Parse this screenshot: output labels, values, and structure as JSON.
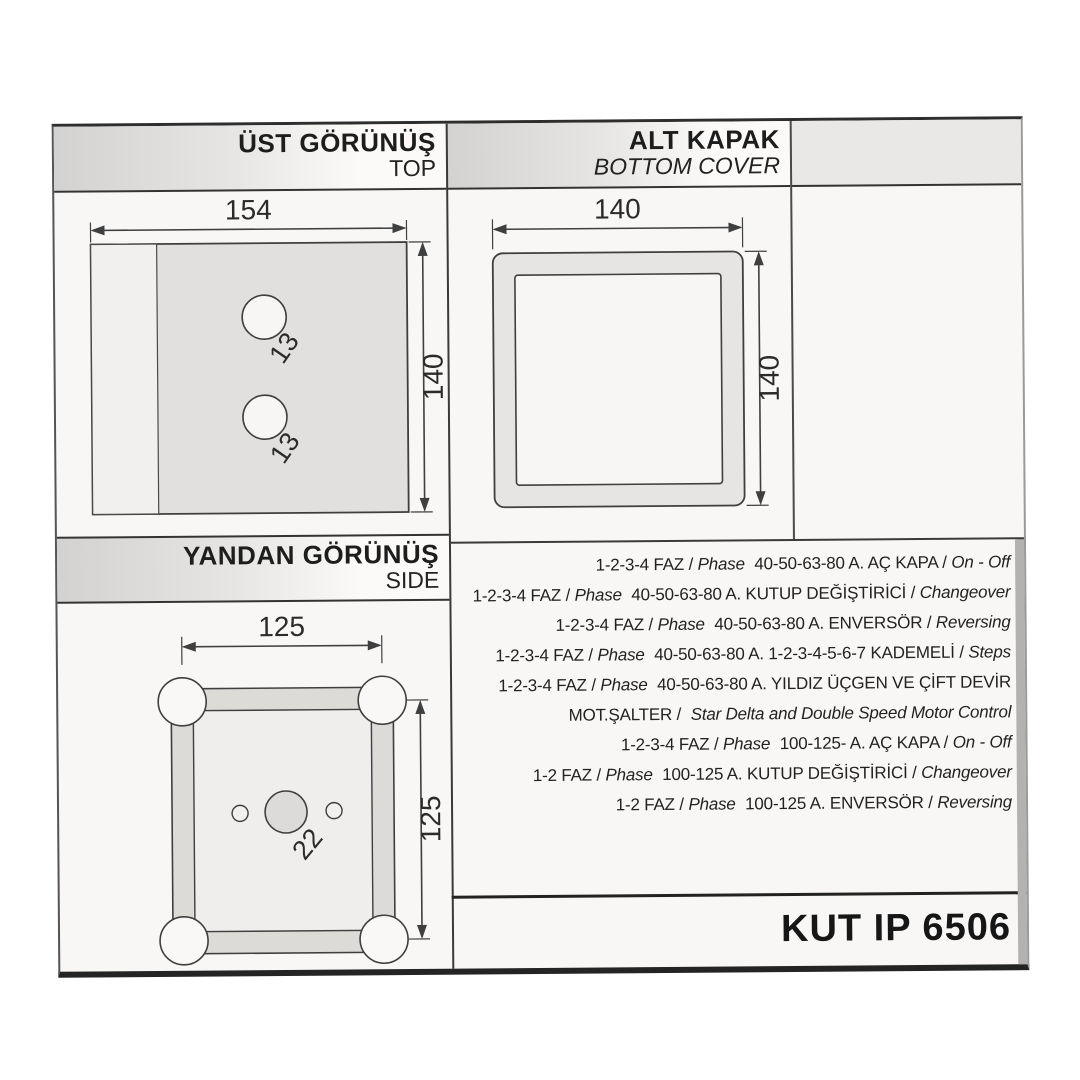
{
  "sections": {
    "top_view": {
      "title_tr": "ÜST GÖRÜNÜŞ",
      "title_en": "TOP"
    },
    "bottom_cover": {
      "title_tr": "ALT KAPAK",
      "title_en": "BOTTOM COVER"
    },
    "side_view": {
      "title_tr": "YANDAN GÖRÜNÜŞ",
      "title_en": "SIDE"
    }
  },
  "drawings": {
    "top_view": {
      "width": "154",
      "height": "140",
      "hole_top": "13",
      "hole_bottom": "13"
    },
    "bottom_cover": {
      "width": "140",
      "height": "140"
    },
    "side_view": {
      "width": "125",
      "height": "125",
      "center_hole": "22"
    }
  },
  "specs": {
    "lines": [
      {
        "a": "1-2-3-4 FAZ /",
        "b": "Phase",
        "c": "40-50-63-80 A. AÇ KAPA /",
        "d": "On - Off"
      },
      {
        "a": "1-2-3-4 FAZ /",
        "b": "Phase",
        "c": "40-50-63-80 A. KUTUP DEĞİŞTİRİCİ /",
        "d": "Changeover"
      },
      {
        "a": "1-2-3-4 FAZ /",
        "b": "Phase",
        "c": "40-50-63-80 A. ENVERSÖR /",
        "d": "Reversing"
      },
      {
        "a": "1-2-3-4 FAZ /",
        "b": "Phase",
        "c": "40-50-63-80 A. 1-2-3-4-5-6-7 KADEMELİ /",
        "d": "Steps"
      },
      {
        "a": "1-2-3-4 FAZ /",
        "b": "Phase",
        "c": "40-50-63-80 A. YILDIZ ÜÇGEN VE ÇİFT DEVİR",
        "d": ""
      },
      {
        "a": "MOT.ŞALTER /",
        "b": "",
        "c": "",
        "d": "Star Delta and Double Speed Motor Control"
      },
      {
        "a": "1-2-3-4 FAZ /",
        "b": "Phase",
        "c": "100-125- A. AÇ KAPA /",
        "d": "On - Off"
      },
      {
        "a": "1-2 FAZ /",
        "b": "Phase",
        "c": "100-125 A. KUTUP DEĞİŞTİRİCİ /",
        "d": "Changeover"
      },
      {
        "a": "1-2 FAZ /",
        "b": "Phase",
        "c": "100-125 A. ENVERSÖR /",
        "d": "Reversing"
      }
    ]
  },
  "title_block": {
    "product_code": "KUT IP 6506"
  },
  "colors": {
    "line": "#3a3a3a",
    "panel_gray": "#e1e0de",
    "panel_light": "#f1f0ee",
    "frame_gray": "#dcdbd8",
    "hole_white": "#f7f6f4",
    "center_hole_gray": "#dcdbd9",
    "header_gray": "#d3d2d0",
    "page_bg": "#f8f7f5"
  }
}
